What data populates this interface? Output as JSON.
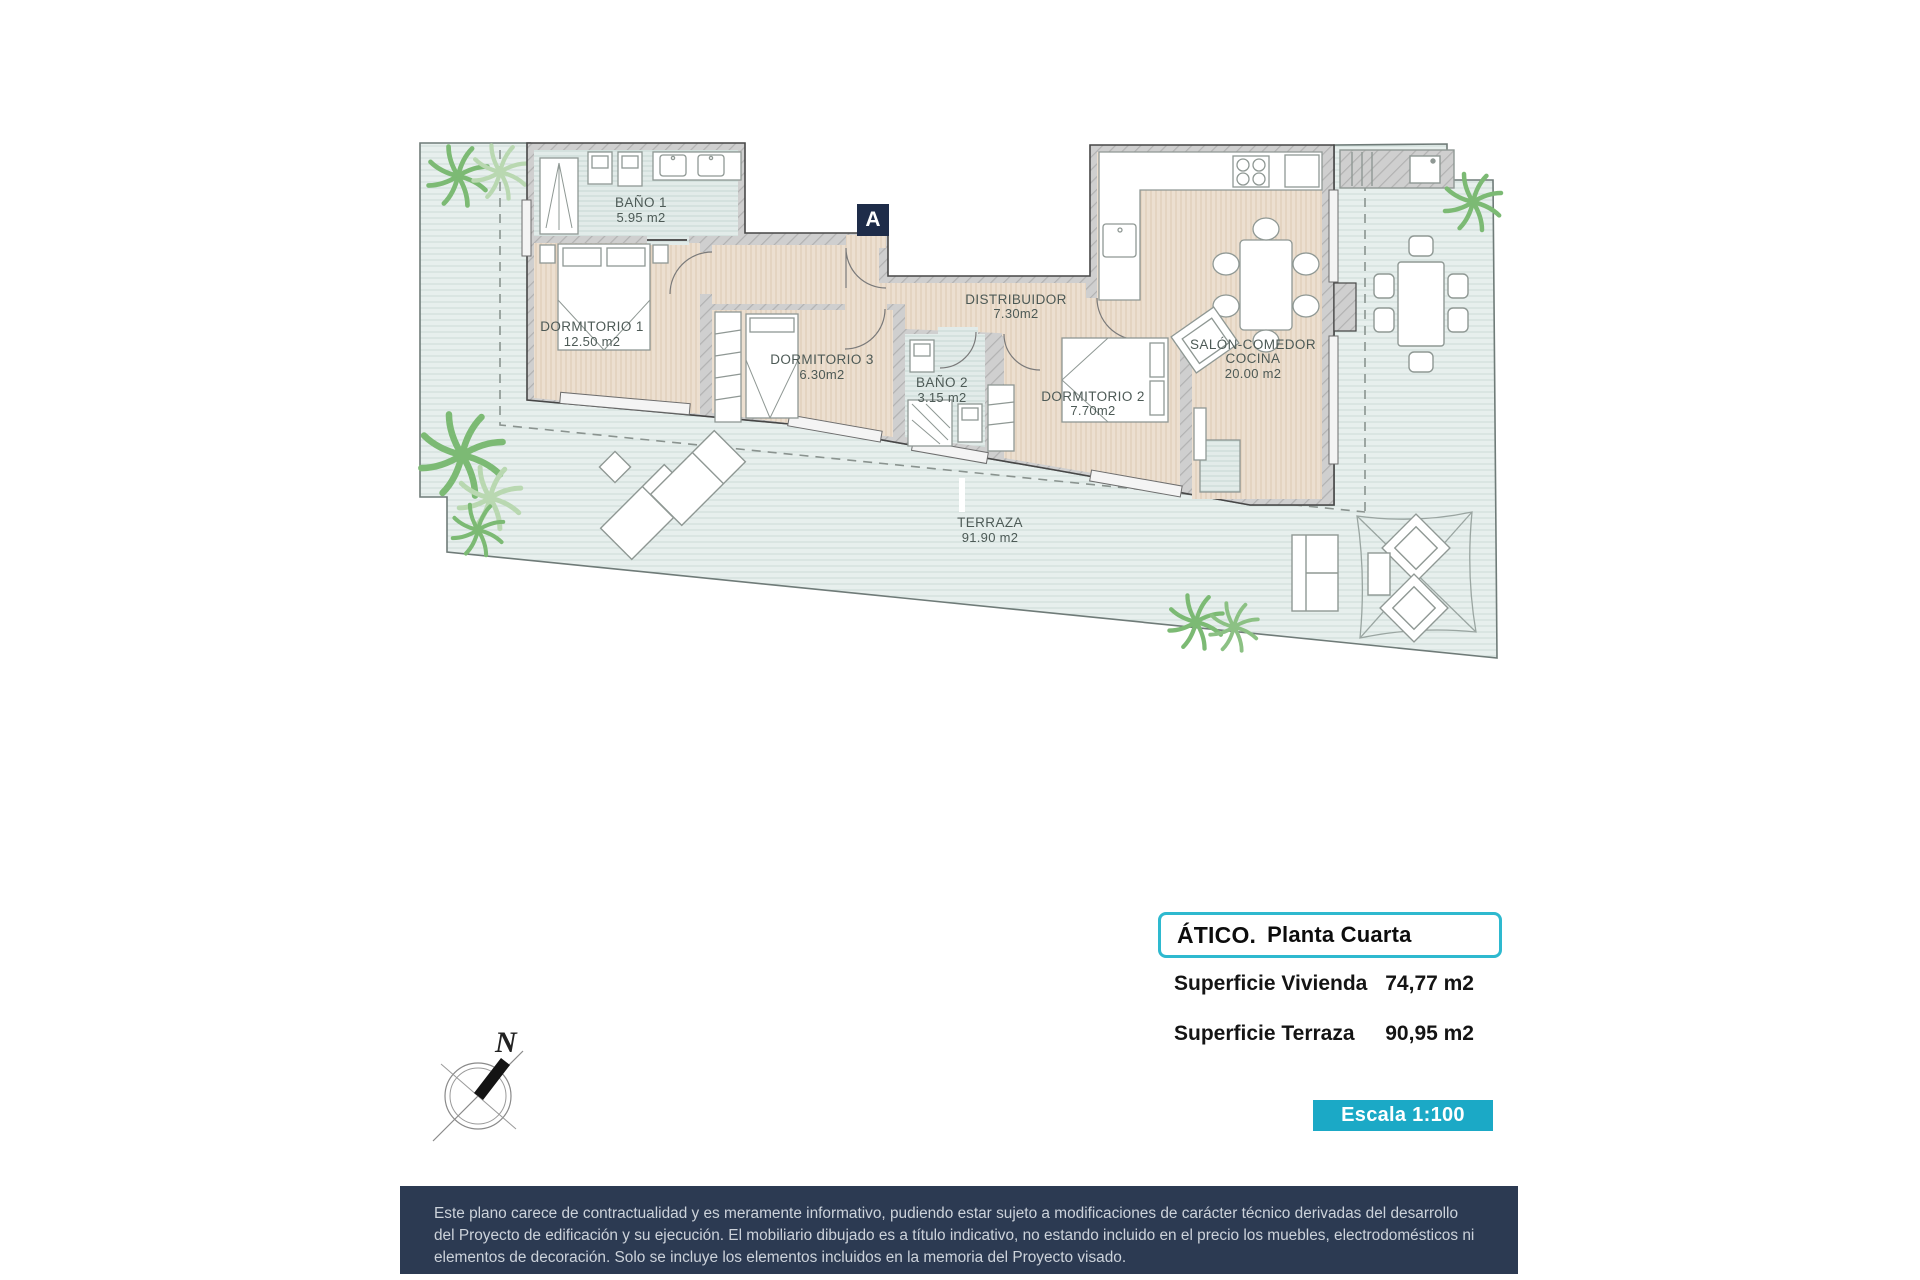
{
  "plan": {
    "badge": "A",
    "compass_label": "N",
    "rooms": [
      {
        "name": "BAÑO 1",
        "area": "5.95 m2"
      },
      {
        "name": "DORMITORIO 1",
        "area": "12.50 m2"
      },
      {
        "name": "DORMITORIO 3",
        "area": "6.30m2"
      },
      {
        "name": "BAÑO 2",
        "area": "3.15 m2"
      },
      {
        "name": "DISTRIBUIDOR",
        "area": "7.30m2"
      },
      {
        "name": "DORMITORIO 2",
        "area": "7.70m2"
      },
      {
        "name": "SALÓN-COMEDOR",
        "name2": "COCINA",
        "area": "20.00 m2"
      },
      {
        "name": "TERRAZA",
        "area": "91.90 m2"
      }
    ]
  },
  "panel": {
    "title_bold": "ÁTICO.",
    "title_rest": "Planta Cuarta",
    "rows": [
      {
        "label": "Superficie Vivienda",
        "value": "74,77 m2"
      },
      {
        "label": "Superficie Terraza",
        "value": "90,95 m2"
      }
    ],
    "scale_label": "Escala 1:100"
  },
  "disclaimer": {
    "line1": "Este plano carece de contractualidad y es meramente informativo, pudiendo estar sujeto a modificaciones de carácter técnico derivadas del desarrollo",
    "line2": "del Proyecto de edificación y su ejecución. El mobiliario dibujado es a título indicativo, no estando incluido en el precio los muebles, electrodomésticos ni",
    "line3": "elementos de decoración. Solo se incluye los elementos incluidos en la memoria del Proyecto visado."
  },
  "colors": {
    "accent_cyan": "#1ba9c6",
    "box_border": "#2eb9cf",
    "badge_navy": "#1e2c49",
    "disclaimer_bg": "#2c3a52",
    "wall_gray": "#cfcfcf",
    "room_floor": "#ecdfd0",
    "wet_floor": "#e3ecea",
    "palm_green": "#7cba74"
  }
}
